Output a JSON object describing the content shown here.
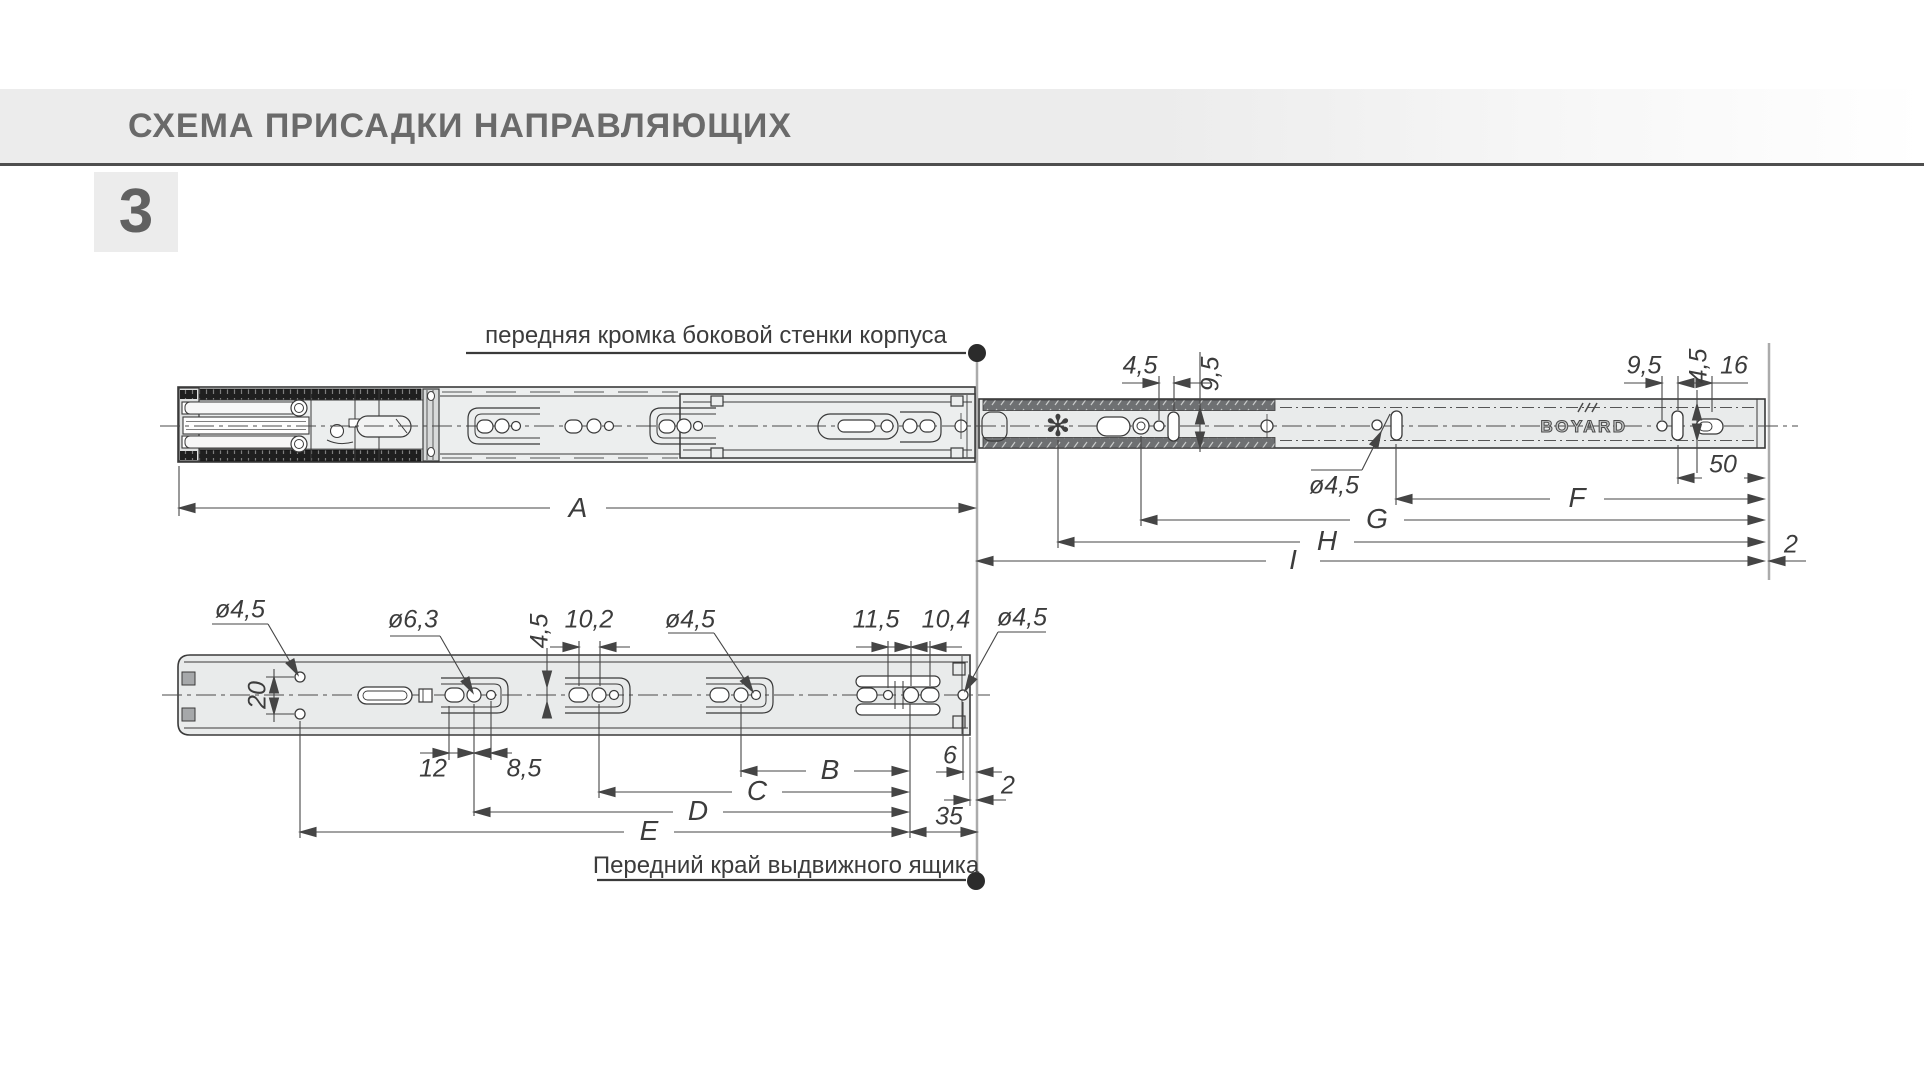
{
  "header": {
    "title": "СХЕМА ПРИСАДКИ НАПРАВЛЯЮЩИХ",
    "section_number": "3"
  },
  "top_view": {
    "note": "передняя кромка боковой стенки корпуса",
    "brand": "BOYARD",
    "dims": {
      "a": "A",
      "f": "F",
      "g": "G",
      "h": "H",
      "i": "I",
      "offset_45": "4,5",
      "height_95": "9,5",
      "dia_45": "ø4,5",
      "rear_95": "9,5",
      "rear_45": "4,5",
      "rear_16": "16",
      "rear_50": "50",
      "gap_2": "2"
    }
  },
  "bottom_view": {
    "note": "Передний край выдвижного ящика",
    "dims": {
      "dia45_front": "ø4,5",
      "spacing_20": "20",
      "dia63": "ø6,3",
      "d12": "12",
      "d85": "8,5",
      "v45": "4,5",
      "d102": "10,2",
      "dia45_mid": "ø4,5",
      "d115": "11,5",
      "d104": "10,4",
      "dia45_end": "ø4,5",
      "d6": "6",
      "d2": "2",
      "d35": "35",
      "b": "B",
      "c": "C",
      "d": "D",
      "e": "E"
    }
  },
  "icons": {
    "euro_hook_hole": "✻"
  }
}
